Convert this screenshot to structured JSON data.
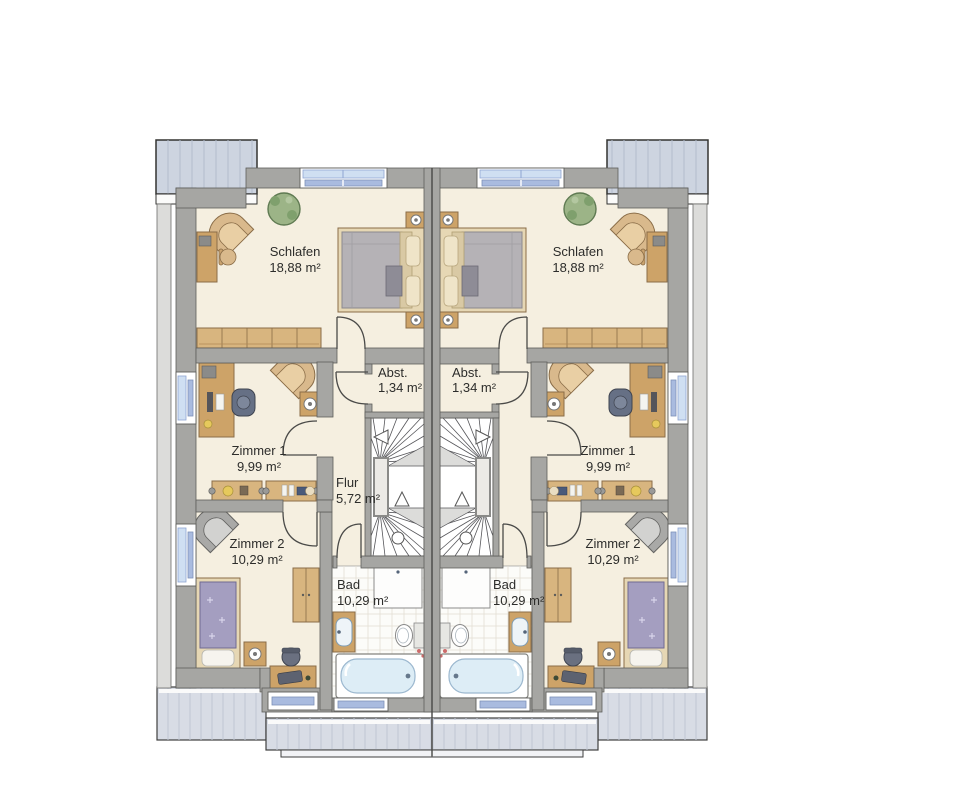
{
  "plan": {
    "kind": "floor-plan",
    "units": {
      "left": {
        "schlafen": {
          "label": "Schlafen",
          "area": "18,88 m²"
        },
        "zimmer1": {
          "label": "Zimmer 1",
          "area": "9,99 m²"
        },
        "zimmer2": {
          "label": "Zimmer 2",
          "area": "10,29 m²"
        },
        "flur": {
          "label": "Flur",
          "area": "5,72 m²"
        },
        "abst": {
          "label": "Abst.",
          "area": "1,34 m²"
        },
        "bad": {
          "label": "Bad",
          "area": "10,29 m²"
        }
      },
      "right": {
        "schlafen": {
          "label": "Schlafen",
          "area": "18,88 m²"
        },
        "zimmer1": {
          "label": "Zimmer 1",
          "area": "9,99 m²"
        },
        "zimmer2": {
          "label": "Zimmer 2",
          "area": "10,29 m²"
        },
        "abst": {
          "label": "Abst.",
          "area": "1,34 m²"
        },
        "bad": {
          "label": "Bad",
          "area": "10,29 m²"
        }
      }
    },
    "colors": {
      "wall": "#a6a6a3",
      "floor_cream": "#f5efe0",
      "bath_tile": "#fcfcf9",
      "wood": "#cda368",
      "window_glass": "#cfdff2",
      "balcony": "#cdd4e0",
      "terrace": "#d8dce5",
      "bed_duvet_gray": "#b5b2b6",
      "bed_duvet_purple": "#a49ec0"
    }
  }
}
